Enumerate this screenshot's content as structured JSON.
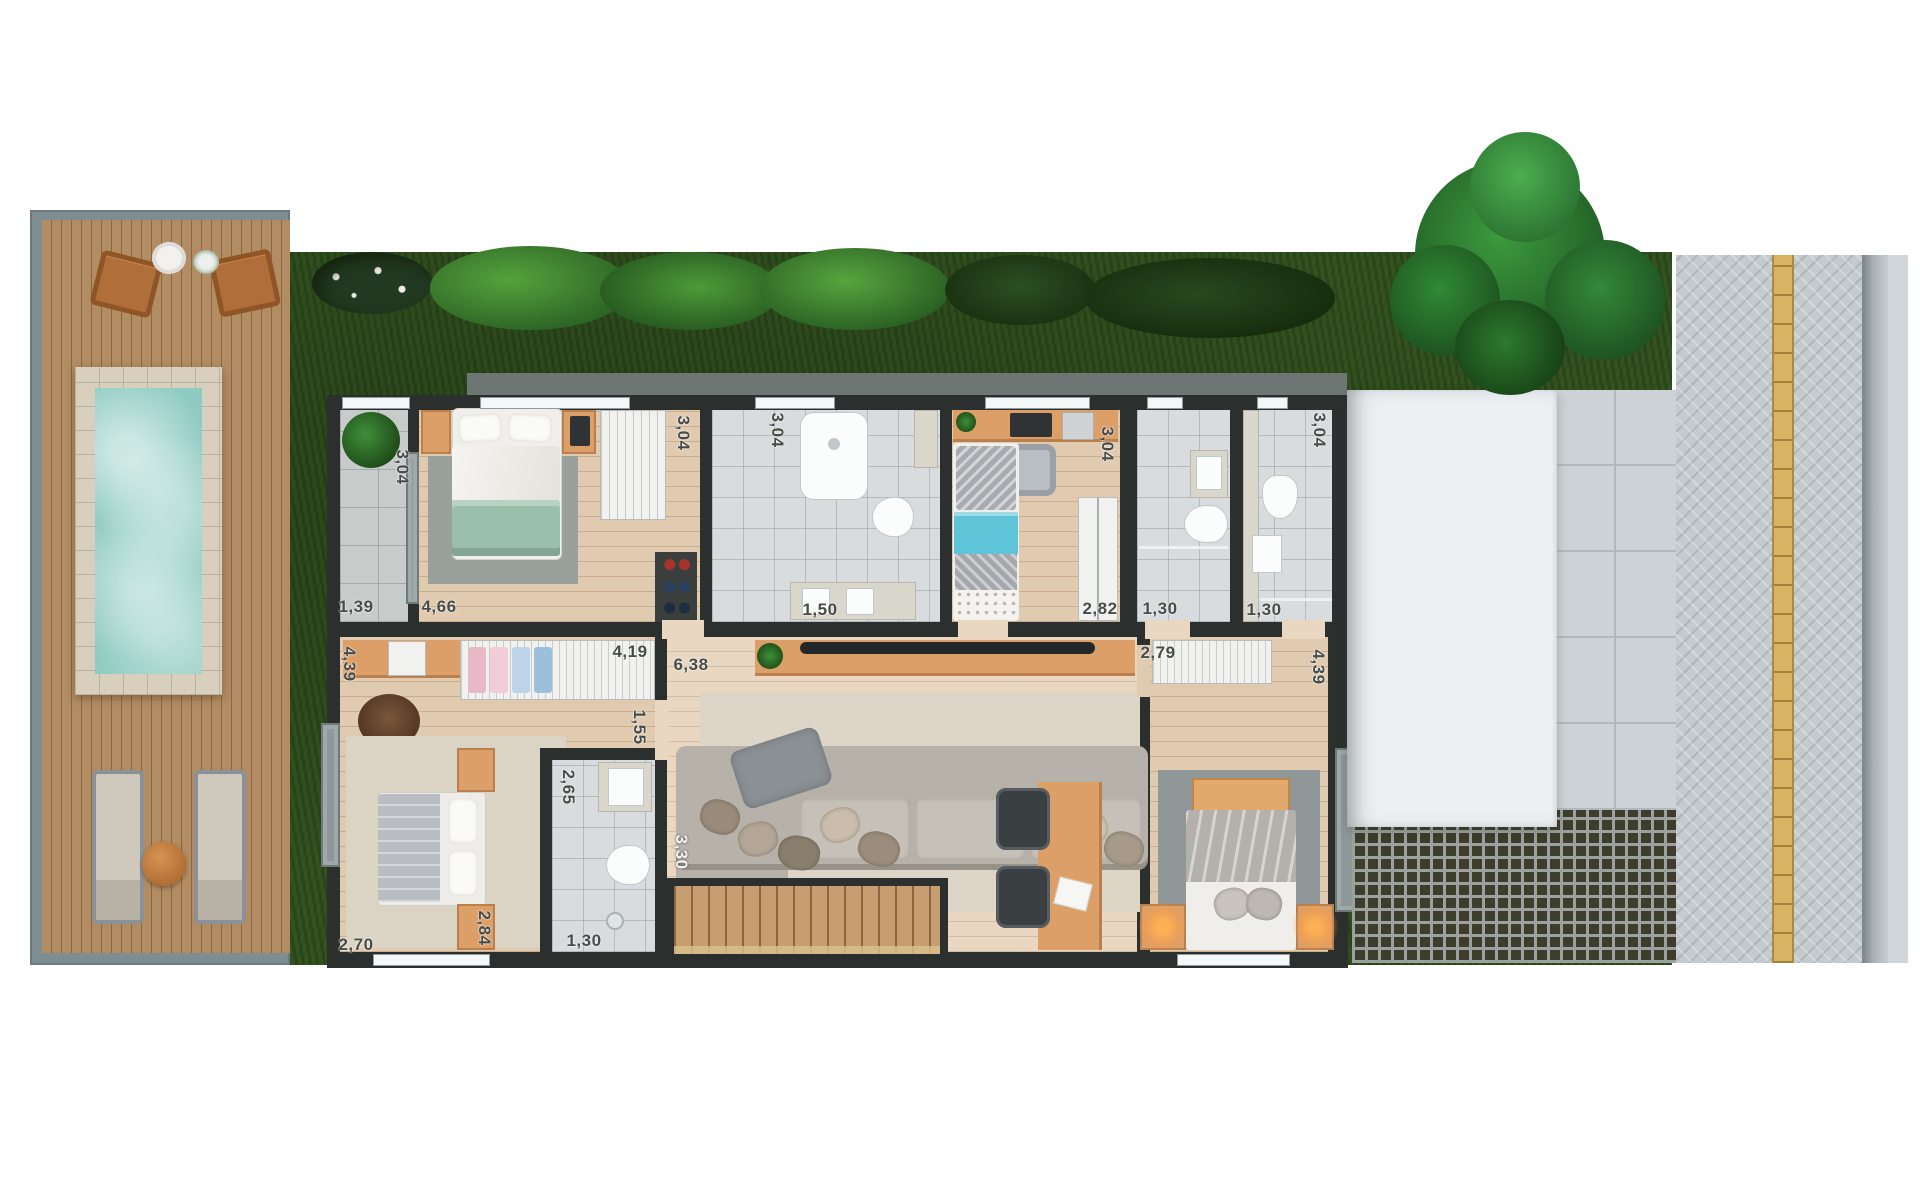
{
  "plan": {
    "dimensions": {
      "balcony_depth": "3,04",
      "balcony_width": "1,39",
      "master_width": "4,66",
      "master_closet_depth": "3,04",
      "ensuite_depth": "3,04",
      "ensuite_width": "1,50",
      "kids_room_depth": "3,04",
      "kids_closet_width": "2,82",
      "bath3_width": "1,30",
      "bath4_depth": "3,04",
      "bath4_width": "1,30",
      "bedroom3_depth": "4,39",
      "bedroom3_closet_width": "4,19",
      "hall_length": "6,38",
      "hall_width": "1,55",
      "bath2_depth": "2,65",
      "bedroom3_nook": "2,84",
      "bedroom3_width": "2,70",
      "bath2_width": "1,30",
      "stair_length": "3,30",
      "suite_closet_width": "2,79",
      "suite_depth": "4,39"
    },
    "colors": {
      "wall": "#2b302e",
      "wood_floor": "#e0cbb0",
      "deck_wood": "#ad895e",
      "grass": "#31501f",
      "pool_water": "#8fcbc2",
      "accent_wood": "#dc9f67",
      "bathroom_tile": "#d8dcde",
      "roof": "#edf0f2",
      "lattice": "#3e3c2a",
      "tactile_strip": "#d9b364",
      "green_blanket": "#9abfab",
      "kids_blue": "#5ec4d8"
    }
  }
}
